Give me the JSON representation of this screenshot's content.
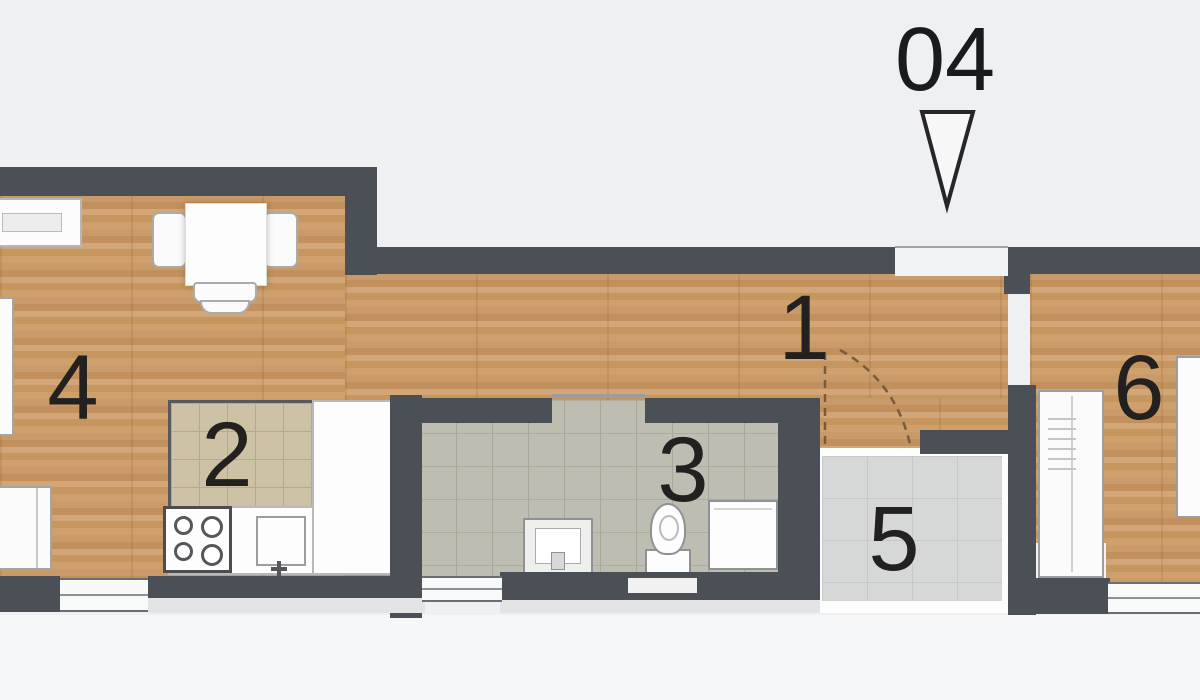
{
  "plan_title": "apartment floor plan",
  "marker": {
    "unit_label": "04",
    "arrow_icon": "down-triangle"
  },
  "rooms": [
    {
      "number": "1"
    },
    {
      "number": "2"
    },
    {
      "number": "3"
    },
    {
      "number": "4"
    },
    {
      "number": "5"
    },
    {
      "number": "6"
    }
  ],
  "palette": {
    "wall": "#4b4f56",
    "wood": "#c99b6b",
    "kitchen-tile": "#cdc1a6",
    "bath-tile": "#bdbdb1",
    "entry-tile": "#d6d7d7",
    "furniture": "#fbfbfb",
    "bg-top": "#eff0f1",
    "bg-bottom": "#f6f7f8",
    "text": "#23211f"
  }
}
